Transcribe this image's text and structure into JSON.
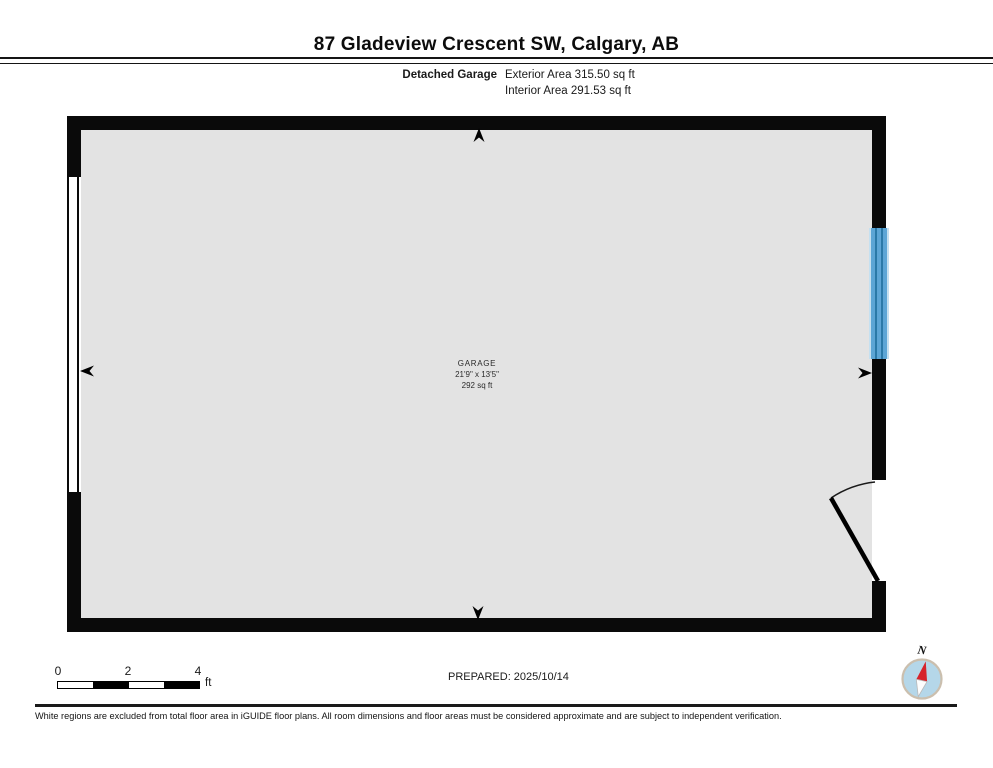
{
  "header": {
    "title": "87 Gladeview Crescent SW, Calgary, AB",
    "floor_label": "Detached Garage",
    "exterior_area": "Exterior Area 315.50 sq ft",
    "interior_area": "Interior Area 291.53 sq ft"
  },
  "plan": {
    "room": {
      "name": "GARAGE",
      "dimensions": "21'9\" x 13'5\"",
      "area": "292 sq ft"
    },
    "features": [
      "garage-door-left-wall",
      "window-right-wall",
      "swing-door-bottom-right",
      "dimension-arrows-4"
    ]
  },
  "scale_bar": {
    "tick_0": "0",
    "tick_2": "2",
    "tick_4": "4",
    "unit": "ft"
  },
  "prepared": "PREPARED: 2025/10/14",
  "compass": {
    "north_label": "N"
  },
  "footer": {
    "disclaimer": "White regions are excluded from total floor area in iGUIDE floor plans. All room dimensions and floor areas must be considered approximate and are subject to independent verification."
  },
  "colors": {
    "wall-black": "#0a0a0a",
    "floor-gray": "#e3e3e3",
    "window-blue": "#5ca5d5",
    "window-dark": "#2a79a8",
    "window-light": "#c5e0f0",
    "compass-fill": "#b5d7e9",
    "compass-ring": "#cbbfae",
    "compass-red": "#d6232b"
  }
}
